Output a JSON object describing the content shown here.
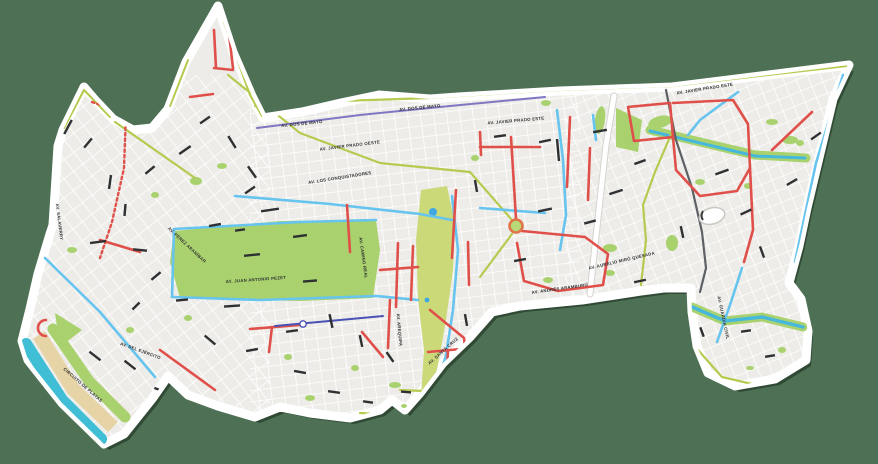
{
  "palette": {
    "background": "#4e7054",
    "map_fill": "#edece8",
    "border": "#ffffff",
    "grid": "#ffffff",
    "park": "#a9d26e",
    "olivar": "#ccd978",
    "water": "#3fbed6",
    "stream": "#45b8dc",
    "pond": "#3fa8e0",
    "sand": "#e7d4a6",
    "road_red": "#e0504b",
    "road_blue": "#66c4ee",
    "road_olive": "#b6ca4f",
    "road_purple": "#8077c2",
    "road_indigo": "#4a52b5",
    "road_gray": "#5d6166",
    "casing": "#d6d4d0",
    "label": "#2e3032"
  },
  "street_labels": [
    {
      "text": "AV. DOS DE MAYO",
      "x": 302,
      "y": 125,
      "r": -6
    },
    {
      "text": "AV. DOS DE MAYO",
      "x": 420,
      "y": 109,
      "r": -6
    },
    {
      "text": "AV. JAVIER PRADO OESTE",
      "x": 350,
      "y": 147,
      "r": -7
    },
    {
      "text": "AV. JAVIER PRADO ESTE",
      "x": 516,
      "y": 122,
      "r": -5
    },
    {
      "text": "AV. JAVIER PRADO ESTE",
      "x": 705,
      "y": 90,
      "r": -9
    },
    {
      "text": "AV. LOS CONQUISTADORES",
      "x": 340,
      "y": 179,
      "r": -9
    },
    {
      "text": "AV. JUAN ANTONIO PEZET",
      "x": 256,
      "y": 281,
      "r": -4
    },
    {
      "text": "AV. CAMINO REAL",
      "x": 362,
      "y": 258,
      "r": 82
    },
    {
      "text": "AV. ANDRÉS ARAMBURÚ",
      "x": 560,
      "y": 290,
      "r": -8
    },
    {
      "text": "AV. AREQUIPA",
      "x": 398,
      "y": 330,
      "r": 85
    },
    {
      "text": "CIRCUITO DE PLAYAS",
      "x": 82,
      "y": 386,
      "r": 41
    },
    {
      "text": "AV. DEL EJÉRCITO",
      "x": 140,
      "y": 352,
      "r": 20
    },
    {
      "text": "AV. GUARDIA CIVIL",
      "x": 722,
      "y": 318,
      "r": 78
    },
    {
      "text": "AV. SALAVERRY",
      "x": 58,
      "y": 222,
      "r": 83
    },
    {
      "text": "AV. PÉREZ ARANÍBAR",
      "x": 186,
      "y": 246,
      "r": 43
    },
    {
      "text": "AV. AURELIO MIRÓ QUESADA",
      "x": 622,
      "y": 262,
      "r": -13
    },
    {
      "text": "AV. SANTA CRUZ",
      "x": 444,
      "y": 352,
      "r": -42
    }
  ],
  "label_dashes": [
    [
      68,
      127,
      16,
      -62
    ],
    [
      88,
      143,
      12,
      -50
    ],
    [
      110,
      182,
      14,
      -82
    ],
    [
      125,
      210,
      12,
      -85
    ],
    [
      98,
      242,
      16,
      -8
    ],
    [
      140,
      250,
      14,
      6
    ],
    [
      150,
      170,
      12,
      -40
    ],
    [
      185,
      150,
      14,
      -35
    ],
    [
      205,
      120,
      12,
      -35
    ],
    [
      232,
      142,
      14,
      58
    ],
    [
      252,
      172,
      14,
      55
    ],
    [
      270,
      210,
      18,
      -8
    ],
    [
      300,
      236,
      14,
      -8
    ],
    [
      252,
      255,
      16,
      -6
    ],
    [
      310,
      281,
      14,
      -5
    ],
    [
      232,
      306,
      16,
      -4
    ],
    [
      210,
      340,
      14,
      40
    ],
    [
      252,
      350,
      12,
      -10
    ],
    [
      292,
      331,
      12,
      -8
    ],
    [
      331,
      321,
      14,
      78
    ],
    [
      361,
      341,
      12,
      78
    ],
    [
      390,
      357,
      12,
      55
    ],
    [
      466,
      320,
      12,
      80
    ],
    [
      520,
      260,
      12,
      -10
    ],
    [
      545,
      210,
      14,
      -12
    ],
    [
      558,
      150,
      22,
      85
    ],
    [
      590,
      222,
      12,
      -15
    ],
    [
      616,
      192,
      14,
      -18
    ],
    [
      640,
      162,
      12,
      -20
    ],
    [
      600,
      131,
      14,
      -10
    ],
    [
      545,
      141,
      12,
      -12
    ],
    [
      500,
      136,
      12,
      -8
    ],
    [
      476,
      186,
      12,
      80
    ],
    [
      610,
      300,
      16,
      -14
    ],
    [
      650,
      310,
      12,
      -14
    ],
    [
      682,
      232,
      12,
      78
    ],
    [
      722,
      172,
      14,
      -20
    ],
    [
      746,
      212,
      12,
      -25
    ],
    [
      762,
      252,
      12,
      70
    ],
    [
      792,
      182,
      12,
      -30
    ],
    [
      816,
      136,
      12,
      -35
    ],
    [
      702,
      332,
      10,
      70
    ],
    [
      746,
      331,
      10,
      -8
    ],
    [
      770,
      356,
      10,
      -10
    ],
    [
      182,
      300,
      12,
      -5
    ],
    [
      156,
      276,
      12,
      -40
    ],
    [
      136,
      306,
      10,
      -45
    ],
    [
      130,
      365,
      14,
      38
    ],
    [
      160,
      390,
      12,
      20
    ],
    [
      300,
      372,
      12,
      10
    ],
    [
      334,
      392,
      12,
      8
    ],
    [
      368,
      402,
      10,
      8
    ],
    [
      406,
      392,
      10,
      5
    ],
    [
      450,
      386,
      10,
      70
    ],
    [
      556,
      311,
      10,
      -10
    ],
    [
      586,
      331,
      10,
      -12
    ],
    [
      640,
      281,
      12,
      -12
    ],
    [
      95,
      356,
      14,
      38
    ],
    [
      250,
      190,
      12,
      -35
    ],
    [
      215,
      225,
      12,
      -10
    ],
    [
      240,
      230,
      10,
      -8
    ]
  ]
}
